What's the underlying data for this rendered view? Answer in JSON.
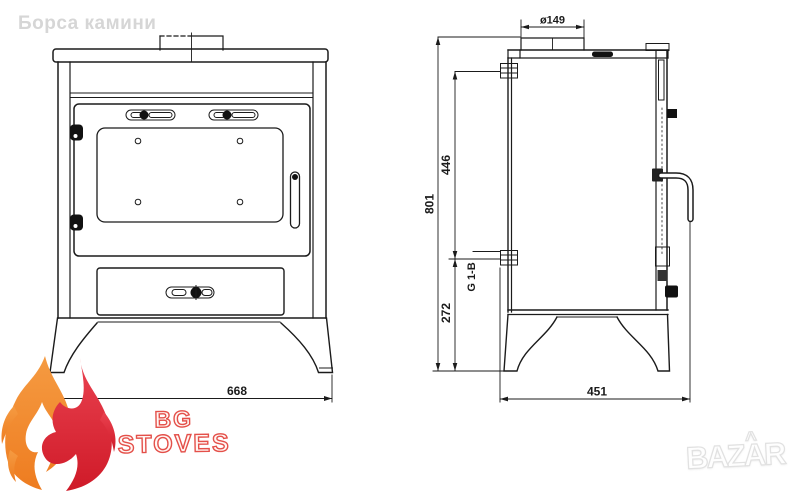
{
  "watermarks": {
    "site_name": "Борса камини",
    "photo_brand": "BAZAR",
    "photo_brand_accent": "^"
  },
  "seller_logo": {
    "line1": "BG",
    "line2": "STOVES"
  },
  "dimensions": {
    "flue_diameter": "ø149",
    "total_height": "801",
    "boiler_ports_span": "446",
    "lower_port_height": "272",
    "port_thread": "G 1-B",
    "front_width": "668",
    "depth": "451"
  },
  "colors": {
    "drawing_line": "#1b1b1b",
    "watermark_gray": "#d6d6d6",
    "logo_red": "#e4504a",
    "flame_orange": "#f08a2e",
    "flame_red": "#dc2636",
    "photo_brand_outline": "#e1e1e1"
  }
}
